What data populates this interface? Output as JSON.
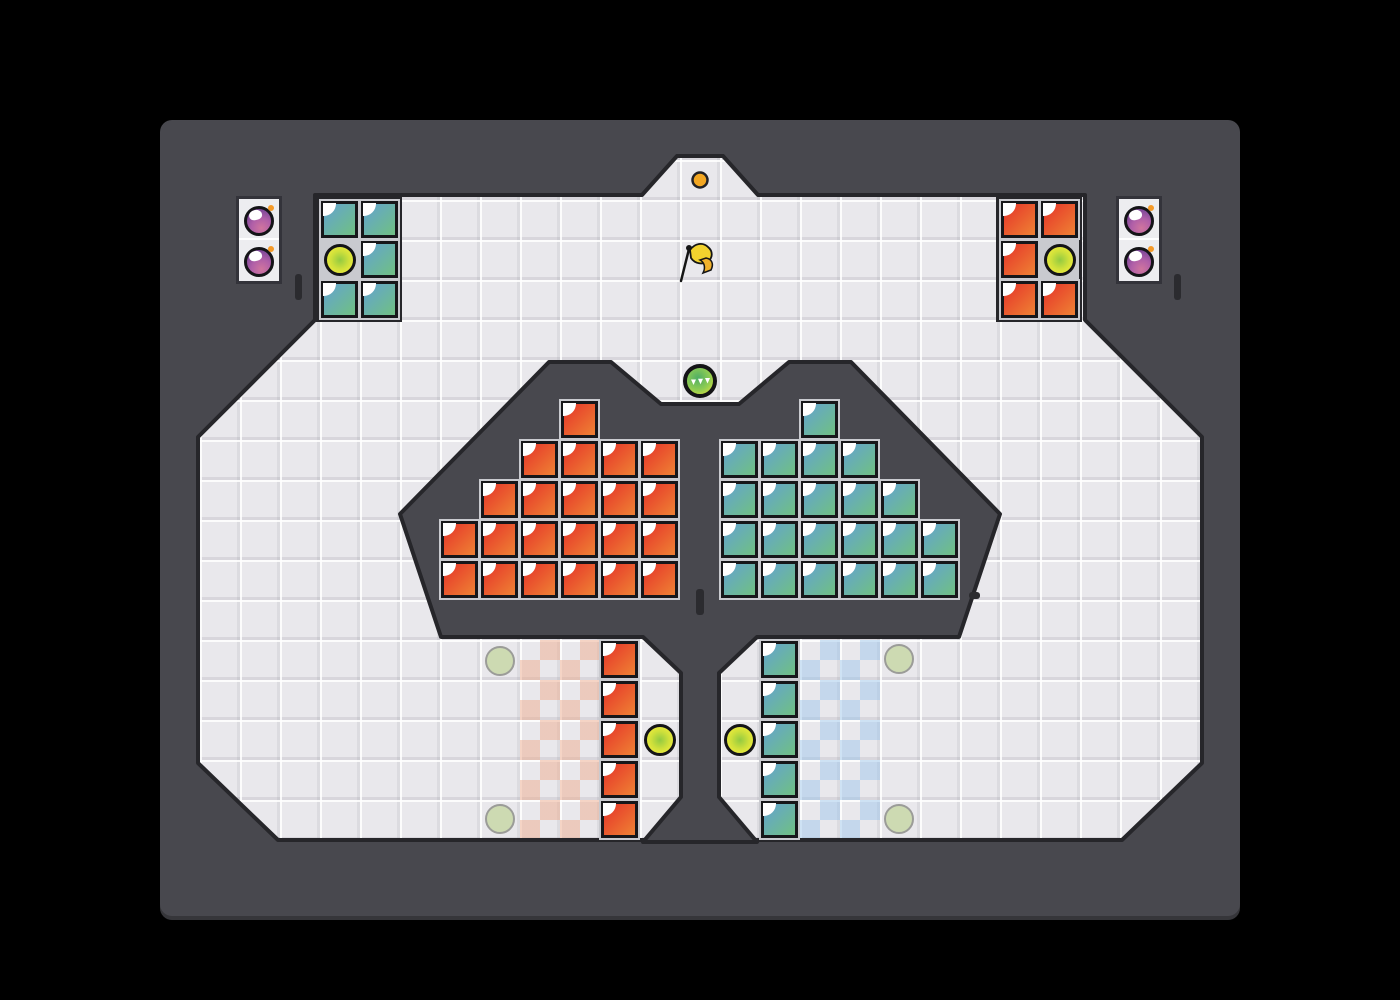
{
  "scene": {
    "width": 1400,
    "height": 1000,
    "grid_tile_px": 40
  },
  "colors": {
    "page_bg": "#000000",
    "frame": "#48484e",
    "structure_edge": "#26262a",
    "field": "#e9e8ec",
    "block_red_a": "#e6392a",
    "block_red_b": "#ee7c33",
    "block_teal_a": "#64a5cb",
    "block_teal_b": "#6fbe88",
    "block_border": "#17171a",
    "block_outline": "#c9cacf",
    "orb_yellow_outer": "#eaea3c",
    "orb_yellow_inner": "#93ca41",
    "orb_green_outer": "#e0e23e",
    "orb_green_inner": "#4fae66",
    "spawn_fill": "rgba(202,216,172,0.9)",
    "spawn_edge": "#9b9c98",
    "panel_bg": "#ededf0",
    "panel_border": "#33333a",
    "bomb_light": "#d0759e",
    "bomb_mid": "#b05fa8",
    "bomb_dark": "#7d4898",
    "fuse": "#f59a28",
    "alcove_dot": "#f3a722",
    "flag_yellow": "#f2d22e",
    "flag_tail": "#f0b12c",
    "tick": "#2b2b2f",
    "checker_red": "rgba(238,172,142,0.5)",
    "checker_blue": "rgba(150,195,235,0.45)"
  },
  "field_polygon": [
    [
      315,
      195
    ],
    [
      642,
      195
    ],
    [
      677,
      156
    ],
    [
      723,
      156
    ],
    [
      758,
      195
    ],
    [
      1085,
      195
    ],
    [
      1085,
      320
    ],
    [
      1202,
      437
    ],
    [
      1202,
      763
    ],
    [
      1122,
      840
    ],
    [
      278,
      840
    ],
    [
      198,
      763
    ],
    [
      198,
      437
    ],
    [
      315,
      320
    ]
  ],
  "structure_polygon": [
    [
      400,
      514
    ],
    [
      549,
      362
    ],
    [
      611,
      362
    ],
    [
      661,
      404
    ],
    [
      739,
      404
    ],
    [
      789,
      362
    ],
    [
      851,
      362
    ],
    [
      1000,
      514
    ],
    [
      959,
      637
    ],
    [
      757,
      637
    ],
    [
      719,
      673
    ],
    [
      719,
      797
    ],
    [
      757,
      842
    ],
    [
      643,
      842
    ],
    [
      681,
      797
    ],
    [
      681,
      673
    ],
    [
      643,
      637
    ],
    [
      441,
      637
    ]
  ],
  "group_housings": [
    {
      "x": 316,
      "y": 196,
      "w": 86,
      "h": 126
    },
    {
      "x": 996,
      "y": 196,
      "w": 86,
      "h": 126
    }
  ],
  "blocks": {
    "red": [
      [
        1000,
        200
      ],
      [
        1040,
        200
      ],
      [
        1000,
        240
      ],
      [
        1000,
        280
      ],
      [
        1040,
        280
      ],
      [
        560,
        400
      ],
      [
        520,
        440
      ],
      [
        560,
        440
      ],
      [
        600,
        440
      ],
      [
        640,
        440
      ],
      [
        480,
        480
      ],
      [
        520,
        480
      ],
      [
        560,
        480
      ],
      [
        600,
        480
      ],
      [
        640,
        480
      ],
      [
        440,
        520
      ],
      [
        480,
        520
      ],
      [
        520,
        520
      ],
      [
        560,
        520
      ],
      [
        600,
        520
      ],
      [
        640,
        520
      ],
      [
        440,
        560
      ],
      [
        480,
        560
      ],
      [
        520,
        560
      ],
      [
        560,
        560
      ],
      [
        600,
        560
      ],
      [
        640,
        560
      ],
      [
        600,
        640
      ],
      [
        600,
        680
      ],
      [
        600,
        720
      ],
      [
        600,
        760
      ],
      [
        600,
        800
      ]
    ],
    "teal": [
      [
        320,
        200
      ],
      [
        360,
        200
      ],
      [
        360,
        240
      ],
      [
        320,
        280
      ],
      [
        360,
        280
      ],
      [
        800,
        400
      ],
      [
        720,
        440
      ],
      [
        760,
        440
      ],
      [
        800,
        440
      ],
      [
        840,
        440
      ],
      [
        720,
        480
      ],
      [
        760,
        480
      ],
      [
        800,
        480
      ],
      [
        840,
        480
      ],
      [
        880,
        480
      ],
      [
        720,
        520
      ],
      [
        760,
        520
      ],
      [
        800,
        520
      ],
      [
        840,
        520
      ],
      [
        880,
        520
      ],
      [
        920,
        520
      ],
      [
        720,
        560
      ],
      [
        760,
        560
      ],
      [
        800,
        560
      ],
      [
        840,
        560
      ],
      [
        880,
        560
      ],
      [
        920,
        560
      ],
      [
        760,
        640
      ],
      [
        760,
        680
      ],
      [
        760,
        720
      ],
      [
        760,
        760
      ],
      [
        760,
        800
      ]
    ]
  },
  "checker_zones": [
    {
      "name": "checker-zone-red",
      "x": 520,
      "y": 640,
      "w": 80,
      "h": 200,
      "color_key": "checker_red"
    },
    {
      "name": "checker-zone-blue",
      "x": 800,
      "y": 640,
      "w": 80,
      "h": 200,
      "color_key": "checker_blue"
    }
  ],
  "yellow_orbs": [
    [
      340,
      260
    ],
    [
      1060,
      260
    ],
    [
      660,
      740
    ],
    [
      740,
      740
    ]
  ],
  "boost_orb": [
    700,
    381
  ],
  "spawn_circles": [
    [
      500,
      661
    ],
    [
      500,
      819
    ],
    [
      899,
      659
    ],
    [
      899,
      819
    ]
  ],
  "bomb_racks": [
    {
      "x": 236,
      "y": 196,
      "bombs": [
        [
          259,
          221
        ],
        [
          259,
          262
        ]
      ]
    },
    {
      "x": 1116,
      "y": 196,
      "bombs": [
        [
          1139,
          221
        ],
        [
          1139,
          262
        ]
      ]
    }
  ],
  "wall_ticks": [
    {
      "x": 295,
      "y": 274,
      "w": 7,
      "h": 26
    },
    {
      "x": 1174,
      "y": 274,
      "w": 7,
      "h": 26
    },
    {
      "x": 696,
      "y": 589,
      "w": 8,
      "h": 26
    },
    {
      "x": 969,
      "y": 592,
      "w": 11,
      "h": 7
    }
  ],
  "alcove_dot": [
    700,
    180
  ],
  "flag": [
    698,
    262
  ],
  "icons": {
    "boost_orb": "triple-fast-forward-triangles",
    "bomb": "sphere-with-orange-fuse",
    "flag": "yellow-pennant-flag"
  }
}
